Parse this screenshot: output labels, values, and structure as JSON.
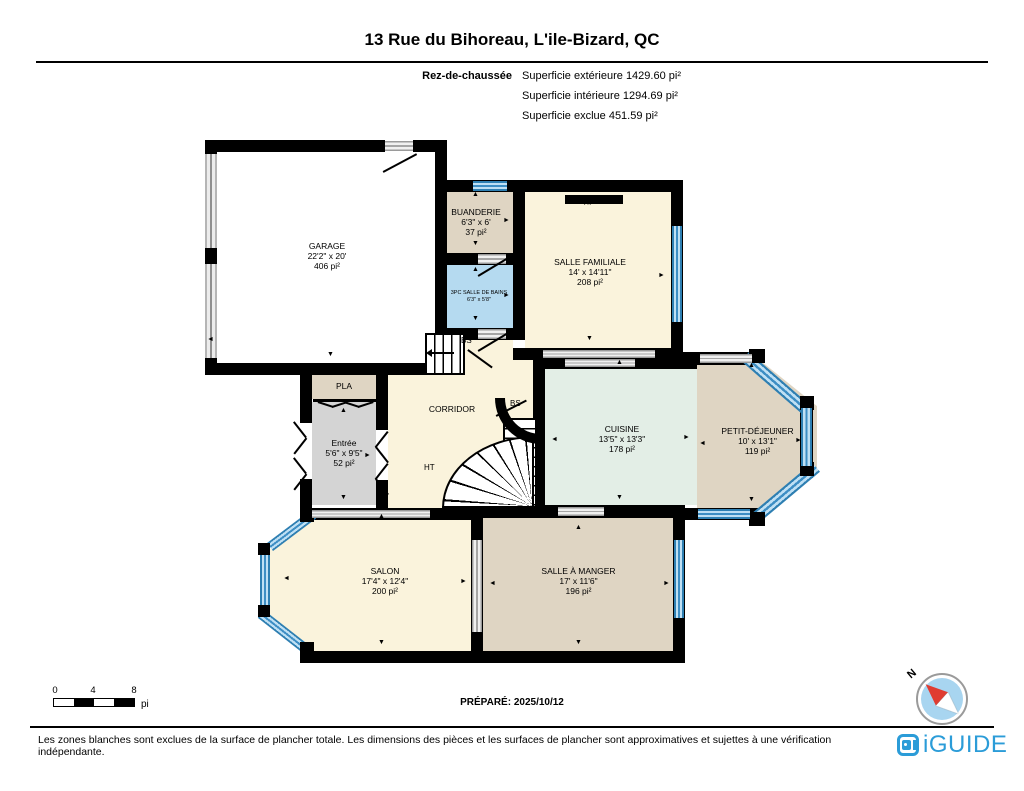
{
  "header": {
    "title": "13 Rue du Bihoreau, L'ile-Bizard, QC",
    "floor_label": "Rez-de-chaussée",
    "areas": [
      "Superficie extérieure 1429.60 pi²",
      "Superficie intérieure 1294.69 pi²",
      "Superficie exclue 451.59 pi²"
    ]
  },
  "rooms": {
    "garage": {
      "name": "GARAGE",
      "dims": "22'2\" x 20'",
      "area": "406 pi²"
    },
    "buanderie": {
      "name": "BUANDERIE",
      "dims": "6'3\" x 6'",
      "area": "37 pi²"
    },
    "bains": {
      "name": "3PC SALLE DE BAINS",
      "dims": "6'3\" x 5'8\""
    },
    "familiale": {
      "name": "SALLE FAMILIALE",
      "dims": "14' x 14'11\"",
      "area": "208 pi²"
    },
    "pla": {
      "name": "PLA"
    },
    "entree": {
      "name": "Entrée",
      "dims": "5'6\" x 9'5\"",
      "area": "52 pi²"
    },
    "corridor": {
      "name": "CORRIDOR"
    },
    "cuisine": {
      "name": "CUISINE",
      "dims": "13'5\" x 13'3\"",
      "area": "178 pi²"
    },
    "dejeuner": {
      "name": "PETIT-DÉJEUNER",
      "dims": "10' x 13'1\"",
      "area": "119 pi²"
    },
    "salon": {
      "name": "SALON",
      "dims": "17'4\" x 12'4\"",
      "area": "200 pi²"
    },
    "manger": {
      "name": "SALLE À MANGER",
      "dims": "17' x 11'6\"",
      "area": "196 pi²"
    }
  },
  "markers": {
    "fireplace": "F/P",
    "stairs_down": "BS",
    "stairs_up": "HT"
  },
  "glyphs": {
    "up": "▲",
    "down": "▼",
    "left": "◄",
    "right": "►"
  },
  "scale": {
    "ticks": [
      "0",
      "4",
      "8"
    ],
    "unit": "pi"
  },
  "prepared": "PRÉPARÉ: 2025/10/12",
  "compass": {
    "north": "N"
  },
  "footer": {
    "disclaimer": "Les zones blanches sont exclues de la surface de plancher totale. Les dimensions des pièces et les surfaces de plancher sont approximatives et sujettes à une vérification indépendante.",
    "brand": "iGUIDE"
  },
  "colors": {
    "wall": "#000000",
    "floor_cream": "#FAF3DC",
    "floor_tan": "#DFD5C3",
    "floor_gray": "#D4D4D4",
    "floor_bath": "#B5DAF0",
    "floor_mint": "#E3EEE6",
    "window_blue": "#4D9DCF",
    "brand_blue": "#2B9CD8",
    "compass_blue": "#A8D5F0",
    "compass_red": "#E03C31"
  }
}
